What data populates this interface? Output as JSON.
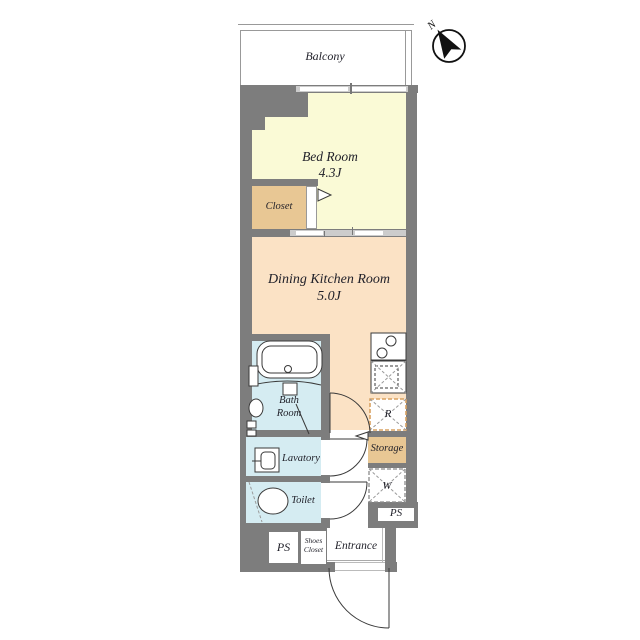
{
  "colors": {
    "wall": "#7d7d7d",
    "bedroom_floor": "#fafad6",
    "dining_floor": "#fbe2c5",
    "closet_floor": "#e8c794",
    "wet_floor": "#d5ecf2",
    "window": "#cccccc",
    "r_dash": "#d9a262",
    "line": "#3a3a3a",
    "text": "#1f1f28"
  },
  "compass": {
    "label": "N"
  },
  "labels": {
    "balcony": "Balcony",
    "bedroom_name": "Bed Room",
    "bedroom_size": "4.3J",
    "closet": "Closet",
    "dining_name": "Dining Kitchen Room",
    "dining_size": "5.0J",
    "bath_line1": "Bath",
    "bath_line2": "Room",
    "lavatory": "Lavatory",
    "toilet": "Toilet",
    "refrigerator": "R",
    "storage": "Storage",
    "washer": "W",
    "ps_right": "PS",
    "ps_left": "PS",
    "shoes_line1": "Shoes",
    "shoes_line2": "Closet",
    "entrance": "Entrance"
  }
}
